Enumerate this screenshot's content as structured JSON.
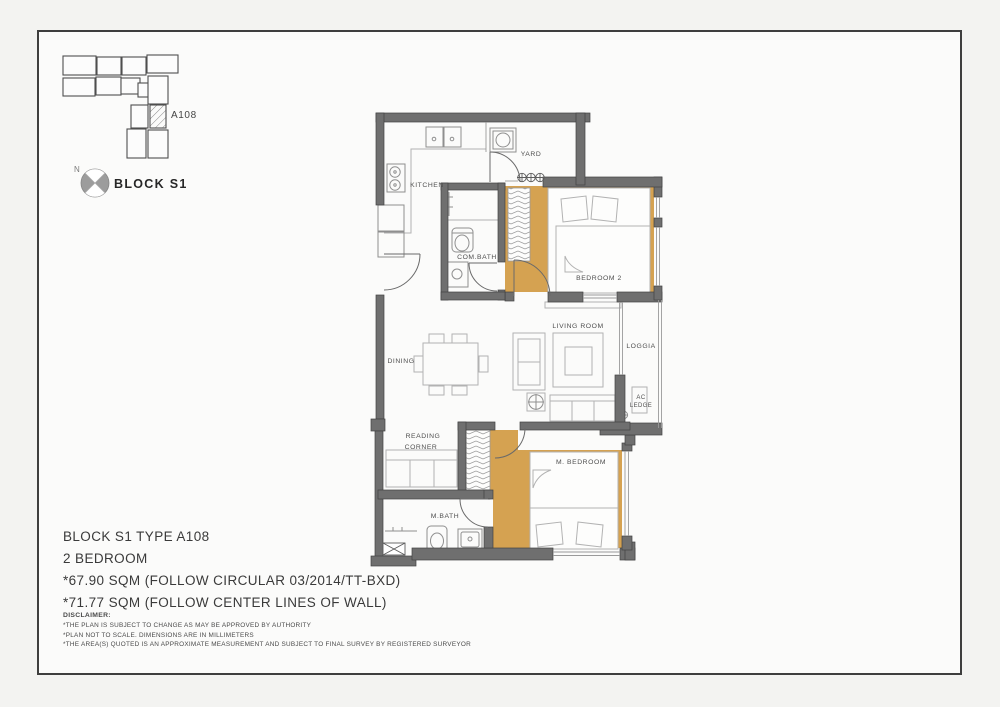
{
  "key_plan": {
    "unit_label": "A108",
    "north_label": "N",
    "block_label": "BLOCK S1"
  },
  "rooms": {
    "kitchen": "KITCHEN",
    "yard": "YARD",
    "com_bath": "COM.BATH",
    "bedroom2": "BEDROOM 2",
    "living": "LIVING  ROOM",
    "loggia": "LOGGIA",
    "ac_line1": "AC",
    "ac_line2": "LEDGE",
    "dining": "DINING",
    "reading_line1": "READING",
    "reading_line2": "CORNER",
    "m_bedroom": "M. BEDROOM",
    "m_bath": "M.BATH"
  },
  "info": {
    "title": "BLOCK S1 TYPE A108",
    "bedrooms": "2 BEDROOM",
    "area_circular": "*67.90  SQM (FOLLOW CIRCULAR 03/2014/TT-BXD)",
    "area_center": "*71.77  SQM (FOLLOW CENTER LINES OF WALL)"
  },
  "disclaimer": {
    "heading": "DISCLAIMER:",
    "lines": [
      "*THE PLAN IS SUBJECT TO CHANGE AS MAY BE APPROVED BY AUTHORITY",
      "*PLAN NOT TO SCALE. DIMENSIONS ARE IN MILLIMETERS",
      "*THE AREA(S) QUOTED IS AN APPROXIMATE MEASUREMENT AND SUBJECT TO FINAL SURVEY BY REGISTERED SURVEYOR"
    ]
  },
  "colors": {
    "floor_accent": "#d5a251",
    "wall": "#6f6f6f"
  }
}
